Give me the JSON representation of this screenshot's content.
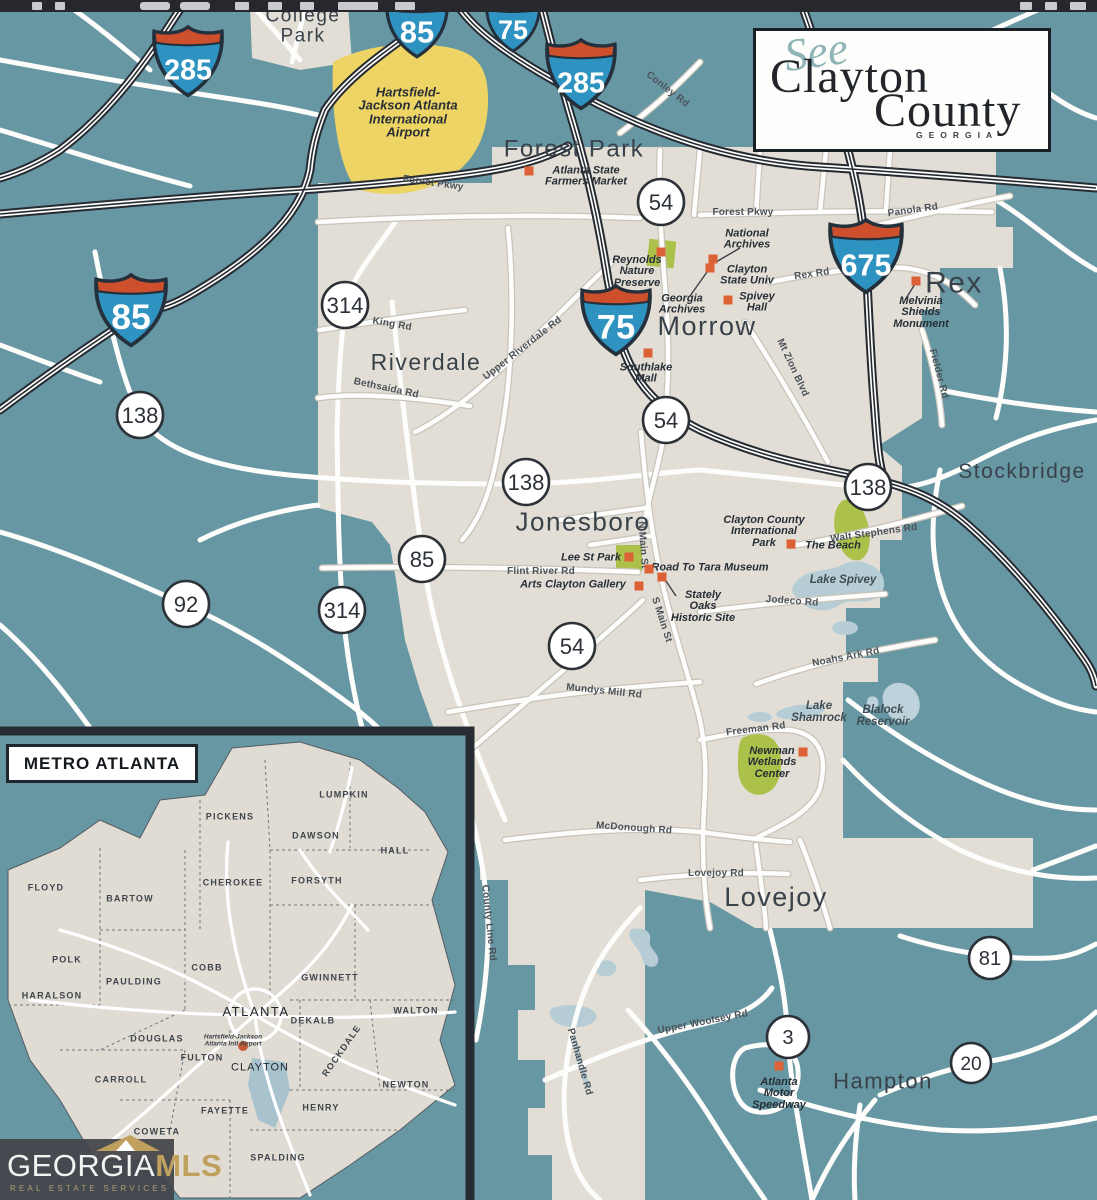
{
  "logo": {
    "script": "See",
    "line1": "Clayton",
    "line2": "County",
    "subtitle": "GEORGIA"
  },
  "brand": {
    "name_a": "GEORGIA",
    "name_b": "MLS",
    "tagline": "REAL ESTATE SERVICES"
  },
  "inset": {
    "title": "METRO ATLANTA",
    "airport_label": "Hartsfield-Jackson\nAtlanta Intl Airport",
    "counties": [
      {
        "t": "LUMPKIN",
        "x": 344,
        "y": 795
      },
      {
        "t": "PICKENS",
        "x": 230,
        "y": 817
      },
      {
        "t": "DAWSON",
        "x": 316,
        "y": 836
      },
      {
        "t": "HALL",
        "x": 395,
        "y": 851
      },
      {
        "t": "FLOYD",
        "x": 46,
        "y": 888
      },
      {
        "t": "CHEROKEE",
        "x": 233,
        "y": 883
      },
      {
        "t": "FORSYTH",
        "x": 317,
        "y": 881
      },
      {
        "t": "BARTOW",
        "x": 130,
        "y": 899
      },
      {
        "t": "POLK",
        "x": 67,
        "y": 960
      },
      {
        "t": "COBB",
        "x": 207,
        "y": 968
      },
      {
        "t": "GWINNETT",
        "x": 330,
        "y": 978
      },
      {
        "t": "PAULDING",
        "x": 134,
        "y": 982
      },
      {
        "t": "HARALSON",
        "x": 52,
        "y": 996
      },
      {
        "t": "ATLANTA",
        "x": 256,
        "y": 1012,
        "cls": "county-big"
      },
      {
        "t": "DEKALB",
        "x": 313,
        "y": 1021
      },
      {
        "t": "WALTON",
        "x": 416,
        "y": 1011
      },
      {
        "t": "DOUGLAS",
        "x": 157,
        "y": 1039
      },
      {
        "t": "FULTON",
        "x": 202,
        "y": 1058
      },
      {
        "t": "ROCKDALE",
        "x": 342,
        "y": 1051,
        "rot": -55
      },
      {
        "t": "CARROLL",
        "x": 121,
        "y": 1080
      },
      {
        "t": "CLAYTON",
        "x": 260,
        "y": 1068,
        "cls": "county-cl"
      },
      {
        "t": "NEWTON",
        "x": 406,
        "y": 1085
      },
      {
        "t": "FAYETTE",
        "x": 225,
        "y": 1111
      },
      {
        "t": "HENRY",
        "x": 321,
        "y": 1108
      },
      {
        "t": "COWETA",
        "x": 157,
        "y": 1132
      },
      {
        "t": "SPALDING",
        "x": 278,
        "y": 1158
      }
    ]
  },
  "map": {
    "airport": {
      "label": "Hartsfield-\nJackson Atlanta\nInternational\nAirport",
      "x": 408,
      "y": 112
    },
    "cities": [
      {
        "t": "College\nPark",
        "x": 303,
        "y": 26,
        "fs": 19
      },
      {
        "t": "Forest Park",
        "x": 574,
        "y": 150,
        "fs": 24
      },
      {
        "t": "Morrow",
        "x": 707,
        "y": 326,
        "fs": 27
      },
      {
        "t": "Rex",
        "x": 954,
        "y": 283,
        "fs": 30
      },
      {
        "t": "Riverdale",
        "x": 426,
        "y": 363,
        "fs": 23
      },
      {
        "t": "Stockbridge",
        "x": 1022,
        "y": 472,
        "fs": 21
      },
      {
        "t": "Jonesboro",
        "x": 583,
        "y": 522,
        "fs": 26
      },
      {
        "t": "Lovejoy",
        "x": 776,
        "y": 897,
        "fs": 27
      },
      {
        "t": "Hampton",
        "x": 883,
        "y": 1082,
        "fs": 22
      }
    ],
    "pois": [
      {
        "t": "Atlanta State\nFarmers Market",
        "x": 586,
        "y": 177,
        "mx": 529,
        "my": 171
      },
      {
        "t": "National\nArchives",
        "x": 747,
        "y": 240,
        "mx": 713,
        "my": 259
      },
      {
        "t": "Reynolds\nNature\nPreserve",
        "x": 637,
        "y": 272,
        "mx": 661,
        "my": 252
      },
      {
        "t": "Clayton\nState Univ",
        "x": 747,
        "y": 276,
        "mx": 710,
        "my": 268
      },
      {
        "t": "Spivey\nHall",
        "x": 757,
        "y": 303,
        "mx": 728,
        "my": 300
      },
      {
        "t": "Georgia\nArchives",
        "x": 682,
        "y": 305
      },
      {
        "t": "Melvinia\nShields\nMonument",
        "x": 921,
        "y": 313,
        "mx": 916,
        "my": 281
      },
      {
        "t": "Southlake\nMall",
        "x": 646,
        "y": 374,
        "mx": 648,
        "my": 353
      },
      {
        "t": "Clayton County\nInternational\nPark",
        "x": 764,
        "y": 532
      },
      {
        "t": "The Beach",
        "x": 833,
        "y": 546,
        "mx": 791,
        "my": 544
      },
      {
        "t": "Lee St Park",
        "x": 591,
        "y": 558,
        "mx": 629,
        "my": 557
      },
      {
        "t": "Road To Tara Museum",
        "x": 710,
        "y": 568,
        "mx": 649,
        "my": 569
      },
      {
        "t": "Arts Clayton Gallery",
        "x": 573,
        "y": 585,
        "mx": 639,
        "my": 586
      },
      {
        "t": "Stately\nOaks\nHistoric Site",
        "x": 703,
        "y": 607,
        "mx": 662,
        "my": 577
      },
      {
        "t": "Newman\nWetlands\nCenter",
        "x": 772,
        "y": 763,
        "mx": 803,
        "my": 752
      },
      {
        "t": "Atlanta\nMotor\nSpeedway",
        "x": 779,
        "y": 1094,
        "mx": 779,
        "my": 1066
      }
    ],
    "water_labels": [
      {
        "t": "Lake Spivey",
        "x": 843,
        "y": 581
      },
      {
        "t": "Lake\nShamrock",
        "x": 819,
        "y": 713
      },
      {
        "t": "Blalock\nReservoir",
        "x": 883,
        "y": 717
      }
    ],
    "road_labels": [
      {
        "t": "Forest Pkwy",
        "x": 433,
        "y": 184,
        "rot": 8
      },
      {
        "t": "Conley Rd",
        "x": 667,
        "y": 90,
        "rot": 38
      },
      {
        "t": "Forest Pkwy",
        "x": 743,
        "y": 213
      },
      {
        "t": "Panola Rd",
        "x": 913,
        "y": 211,
        "rot": -8
      },
      {
        "t": "Rex Rd",
        "x": 812,
        "y": 275,
        "rot": -8
      },
      {
        "t": "King Rd",
        "x": 392,
        "y": 325,
        "rot": 10
      },
      {
        "t": "Upper Riverdale Rd",
        "x": 523,
        "y": 349,
        "rot": -38
      },
      {
        "t": "Bethsaida Rd",
        "x": 386,
        "y": 389,
        "rot": 12
      },
      {
        "t": "Mt Zion Blvd",
        "x": 792,
        "y": 368,
        "rot": 65
      },
      {
        "t": "Fielder Rd",
        "x": 938,
        "y": 374,
        "rot": 75
      },
      {
        "t": "Walt Stephens Rd",
        "x": 874,
        "y": 534,
        "rot": -8
      },
      {
        "t": "Jodeco Rd",
        "x": 792,
        "y": 602,
        "rot": 4
      },
      {
        "t": "N Main St",
        "x": 642,
        "y": 545,
        "rot": 86
      },
      {
        "t": "S Main St",
        "x": 661,
        "y": 620,
        "rot": 72
      },
      {
        "t": "Flint River Rd",
        "x": 541,
        "y": 572
      },
      {
        "t": "Mundys Mill Rd",
        "x": 604,
        "y": 692,
        "rot": 6
      },
      {
        "t": "Noahs Ark Rd",
        "x": 846,
        "y": 658,
        "rot": -11
      },
      {
        "t": "Freeman Rd",
        "x": 756,
        "y": 730,
        "rot": -7
      },
      {
        "t": "McDonough Rd",
        "x": 634,
        "y": 829,
        "rot": 4
      },
      {
        "t": "Lovejoy Rd",
        "x": 716,
        "y": 874
      },
      {
        "t": "County Line Rd",
        "x": 488,
        "y": 923,
        "rot": 84
      },
      {
        "t": "Panhandle Rd",
        "x": 579,
        "y": 1062,
        "rot": 74
      },
      {
        "t": "Upper Woolsey Rd",
        "x": 703,
        "y": 1023,
        "rot": -11
      }
    ],
    "interstate_shields": [
      {
        "n": "285",
        "x": 188,
        "y": 63,
        "s": 72
      },
      {
        "n": "85",
        "x": 417,
        "y": 28,
        "s": 64
      },
      {
        "n": "75",
        "x": 513,
        "y": 26,
        "s": 56
      },
      {
        "n": "285",
        "x": 581,
        "y": 76,
        "s": 72
      },
      {
        "n": "675",
        "x": 866,
        "y": 258,
        "s": 76
      },
      {
        "n": "75",
        "x": 616,
        "y": 322,
        "s": 72
      },
      {
        "n": "85",
        "x": 131,
        "y": 312,
        "s": 74
      }
    ],
    "state_shields": [
      {
        "n": "54",
        "x": 661,
        "y": 202,
        "d": 46
      },
      {
        "n": "314",
        "x": 345,
        "y": 305,
        "d": 46
      },
      {
        "n": "138",
        "x": 140,
        "y": 415,
        "d": 46
      },
      {
        "n": "54",
        "x": 666,
        "y": 420,
        "d": 46
      },
      {
        "n": "138",
        "x": 526,
        "y": 482,
        "d": 46
      },
      {
        "n": "138",
        "x": 868,
        "y": 487,
        "d": 46
      },
      {
        "n": "85",
        "x": 422,
        "y": 559,
        "d": 46
      },
      {
        "n": "92",
        "x": 186,
        "y": 604,
        "d": 46
      },
      {
        "n": "314",
        "x": 342,
        "y": 610,
        "d": 46
      },
      {
        "n": "54",
        "x": 572,
        "y": 646,
        "d": 46
      },
      {
        "n": "81",
        "x": 990,
        "y": 958,
        "d": 42
      },
      {
        "n": "3",
        "x": 788,
        "y": 1037,
        "d": 42
      },
      {
        "n": "20",
        "x": 971,
        "y": 1063,
        "d": 40
      }
    ]
  },
  "colors": {
    "water": "#6797a3",
    "land": "#e2ded5",
    "airport": "#eed464",
    "poi_marker": "#dd6136",
    "park_green": "#abc14a",
    "lake": "#b7cdd6",
    "shield_blue": "#2f93c1",
    "shield_red": "#cd4f2b",
    "brand_gold": "#bfa05e"
  }
}
